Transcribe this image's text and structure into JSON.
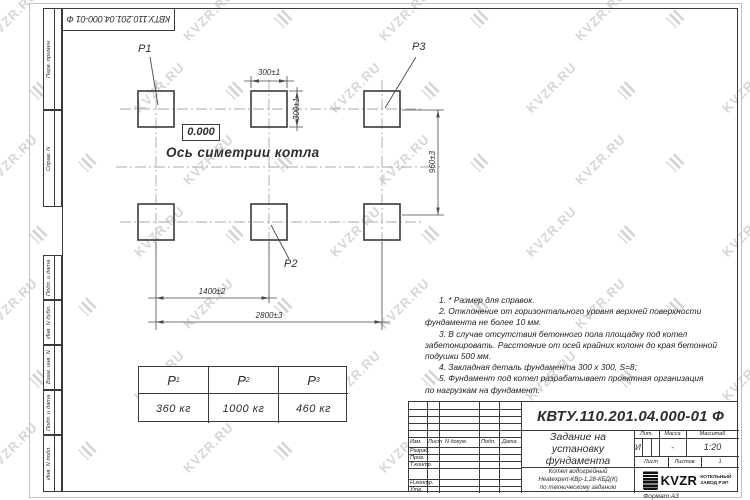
{
  "watermark": {
    "text": "KVZR.RU"
  },
  "colors": {
    "line": "#3a3a3a",
    "dim": "#4a4a4a",
    "centerline": "#a9a9a9",
    "watermark": "#c7c9cf",
    "paper_edge": "#c2c2c2"
  },
  "stamp_doc_number": "КВТУ.110.201.04.000-01 Ф",
  "side_stamps": {
    "top": [
      "Перв. примен.",
      "Справ. N"
    ],
    "bottom": [
      "Подп. и дата",
      "Инв. N дубл.",
      "Взам. инв. N",
      "Подп. и дата",
      "Инв. N подл."
    ]
  },
  "drawing": {
    "pad_labels": {
      "p1": "P1",
      "p2": "P2",
      "p3": "P3"
    },
    "elevation": "0.000",
    "axis_label": "Ось симетрии котла",
    "dims": {
      "pad_width": "300±1",
      "pad_height": "300±1",
      "row_spacing": "960±3",
      "col_spacing": "1400±2",
      "total_span": "2800±3"
    }
  },
  "load_table": {
    "headers": [
      {
        "base": "P",
        "sub": "1"
      },
      {
        "base": "P",
        "sub": "2"
      },
      {
        "base": "P",
        "sub": "3"
      }
    ],
    "values": [
      "360 кг",
      "1000 кг",
      "460 кг"
    ]
  },
  "notes": {
    "lines": [
      "1. * Размер для справок.",
      "2. Отклонение от горизонтального уровня верхней поверхности",
      "фундамента не более 10 мм.",
      "3. В случае отсутствия бетонного пола площадку под котел",
      "забетонировать. Расстояние от осей крайних колонн до края бетонной",
      "подушки 500 мм.",
      "4. Закладная деталь фундамента  300 x 300, S=8;",
      "5. Фундамент под котел разрабатывает проектная организация",
      "по нагрузкам на фундамент."
    ]
  },
  "title_block": {
    "doc_number": "КВТУ.110.201.04.000-01 Ф",
    "title_lines": [
      "Задание на",
      "установку",
      "фундамента"
    ],
    "subtitle_lines": [
      "Котел водогрейный",
      "Heatexpert-КВр-1,28-КБД(К)",
      "по техническому заданию"
    ],
    "rev_headers": [
      "Изм.",
      "Лист",
      "N докум.",
      "Подп.",
      "Дата"
    ],
    "sign_rows": [
      "Разраб.",
      "Пров.",
      "Т.контр.",
      "Н.контр.",
      "Утв."
    ],
    "lit": {
      "headers": [
        "Лит.",
        "Масса",
        "Масштаб"
      ],
      "lit_value": "И",
      "mass_value": "-",
      "scale_value": "1:20"
    },
    "sheet": {
      "list_label": "Лист",
      "listov_label": "Листов",
      "listov_value": "1"
    },
    "company": {
      "logo_text": "KVZR",
      "line1": "КОТЕЛЬНЫЙ",
      "line2": "ЗАВОД РЭП"
    }
  },
  "format_label": "Формат А3"
}
